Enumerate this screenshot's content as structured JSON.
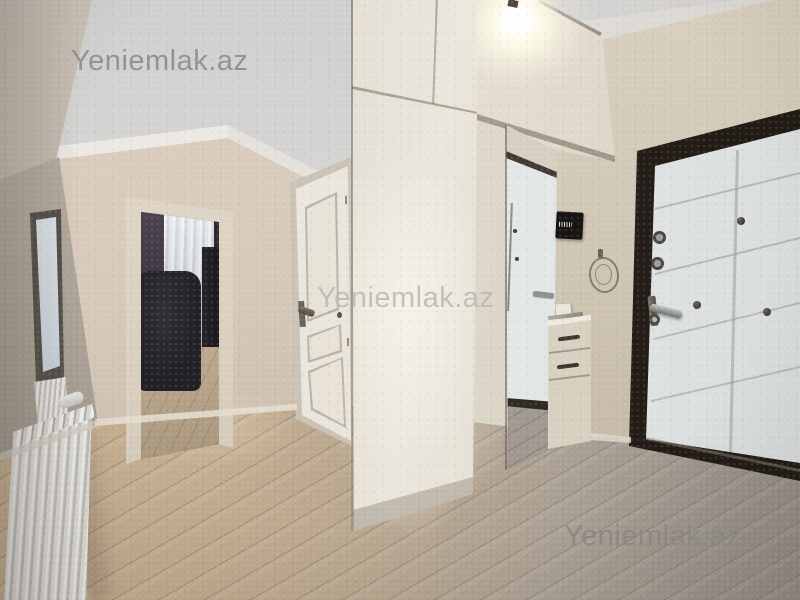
{
  "photo": {
    "scene": "apartment-hallway-interior",
    "watermark": {
      "text": "Yeniemlak.az"
    },
    "objects": {
      "ceiling_light": "bare-bulb",
      "wardrobe": "glossy-cream-wardrobe",
      "mirror": "full-height-mirror",
      "drawer_unit": "two-drawer-cabinet",
      "intercom": "black-wall-intercom",
      "entrance_door": "white-steel-door-dark-frame",
      "interior_door": "white-paneled-door",
      "open_doorway": "room-with-curtains-and-dark-sofa",
      "radiator": "white-aluminum-radiator",
      "floor": "light-laminate-diagonal-planks"
    },
    "colors": {
      "wall": "#cfc5b3",
      "ceiling": "#d8d6d4",
      "wardrobe": "#e7e1d5",
      "floor_warm": "#c3ac8e",
      "floor_gray": "#969087",
      "entrance_door": "#e9eceb",
      "entrance_frame": "#2b231c",
      "interior_door": "#e9e4da",
      "watermark": "#9b9894"
    }
  }
}
